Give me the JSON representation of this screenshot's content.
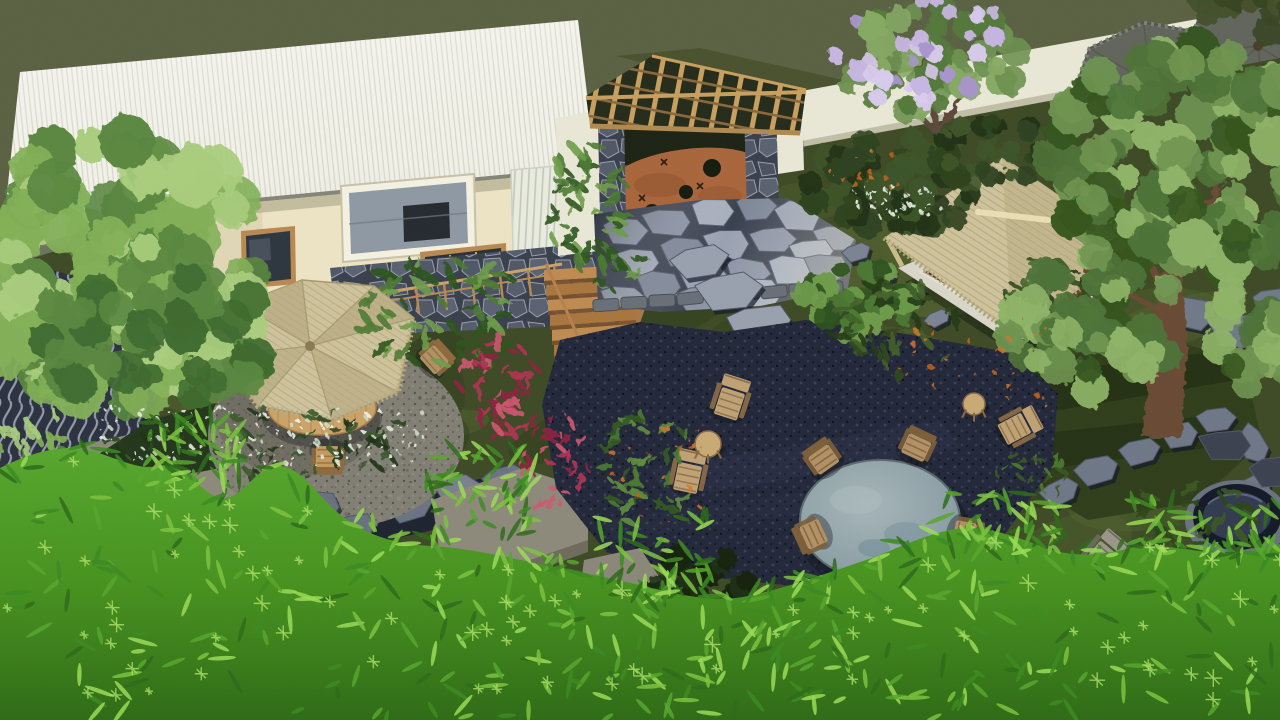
{
  "meta": {
    "title": "Aerial 3D landscape render of a tropical garden",
    "type": "3d-architectural-render",
    "view": "aerial top-down perspective",
    "lighting": "warm afternoon sun from upper right",
    "contents": [
      "white corrugated-roof house with cream walls and stone base",
      "timber pergola entry gate with corten steel door and stone pillars",
      "bluestone flagstone patio and stepping-stone paths",
      "thatched-roof bamboo gazebo on white platform",
      "thatched patio umbrella with wooden table and chairs on gravel circle",
      "round stone table with five wooden chairs on dark gravel court",
      "wooden adirondack lounge chairs with side tables",
      "two grey thatched umbrellas along white boundary wall",
      "stone fire-bowl with stepping stones",
      "patterned breeze-screen fence",
      "tropical planting: red cordyline, heliconia, white flower drifts, lilac blossom tree",
      "large shade trees and bright bamboo foliage foreground"
    ]
  },
  "palette": {
    "olive": "#5b6243",
    "oliveShadow": "#49512e",
    "wall": "#e9e7d5",
    "wallShade": "#c2bfa8",
    "roof": "#f2f2e9",
    "roofEdge": "#8d8d83",
    "houseWall": "#ece4c5",
    "houseWallShade": "#d8cfae",
    "woodTrim": "#b98a52",
    "woodLight": "#caa369",
    "stoneJoint": "#9aa2b2",
    "flagBase": "#39404e",
    "flagStone": "#97a0b0",
    "kerb": "#6a7078",
    "darkGravel": "#23283a",
    "gravelCircle": "#827f75",
    "corten": "#a9663c",
    "cortenDark": "#743f22",
    "gateShadow": "#1d2415",
    "lattice": "#c8a060",
    "thatch": "#cfc39c",
    "thatchShade": "#b9ad84",
    "thatchDark": "#a4986f",
    "grassMid": "#3e4b26",
    "grassDark": "#2c3a1b",
    "grassLight": "#55652f",
    "moss": "#4f5e2d",
    "rightLawn": "#2f3d1b",
    "screenBase": "#2c3240",
    "screenLine": "#96a0b2",
    "bambooTop": "#57a62e",
    "bambooDeep": "#35771b",
    "bambooLight": "#9bdb57",
    "treeLight": "#a9cd7d",
    "treeMid": "#83b058",
    "treeDark": "#5a8740",
    "treeDeep": "#3f6b2f",
    "rtLight": "#8fb468",
    "rtMid": "#6f9450",
    "rtDark": "#4e7338",
    "rtDeep": "#35551f",
    "jungle1": "#6f9c4a",
    "jungle2": "#4c7a33",
    "jungle3": "#2f5420",
    "bedDark": "#24371d",
    "whiteFlower": "#e8efe2",
    "lilac1": "#c8b7e2",
    "lilac2": "#a795cc",
    "red1": "#b23354",
    "red2": "#8e2140",
    "red3": "#cf5670",
    "orange": "#d2762b",
    "tableStone": "#97a7ad",
    "tableStoneDark": "#76878f",
    "chairWood": "#b29165",
    "chairWoodDark": "#7c5f3a",
    "loungeWood": "#bfa275",
    "loungeDark": "#8a6a44",
    "greyChair": "#9a978a",
    "greyChairDark": "#6c6a5e",
    "trunk": "#6b4b34",
    "greyUmb": "#61655c",
    "greyUmbDark": "#53574e",
    "brownUmb": "#6e5136",
    "bowl": "#333b50",
    "bowlRim": "#151a28",
    "rock": "#6a7280",
    "rockDark": "#474e5c",
    "slabHex": "#8d8a7b",
    "slabHexSide": "#6f6c5d"
  }
}
